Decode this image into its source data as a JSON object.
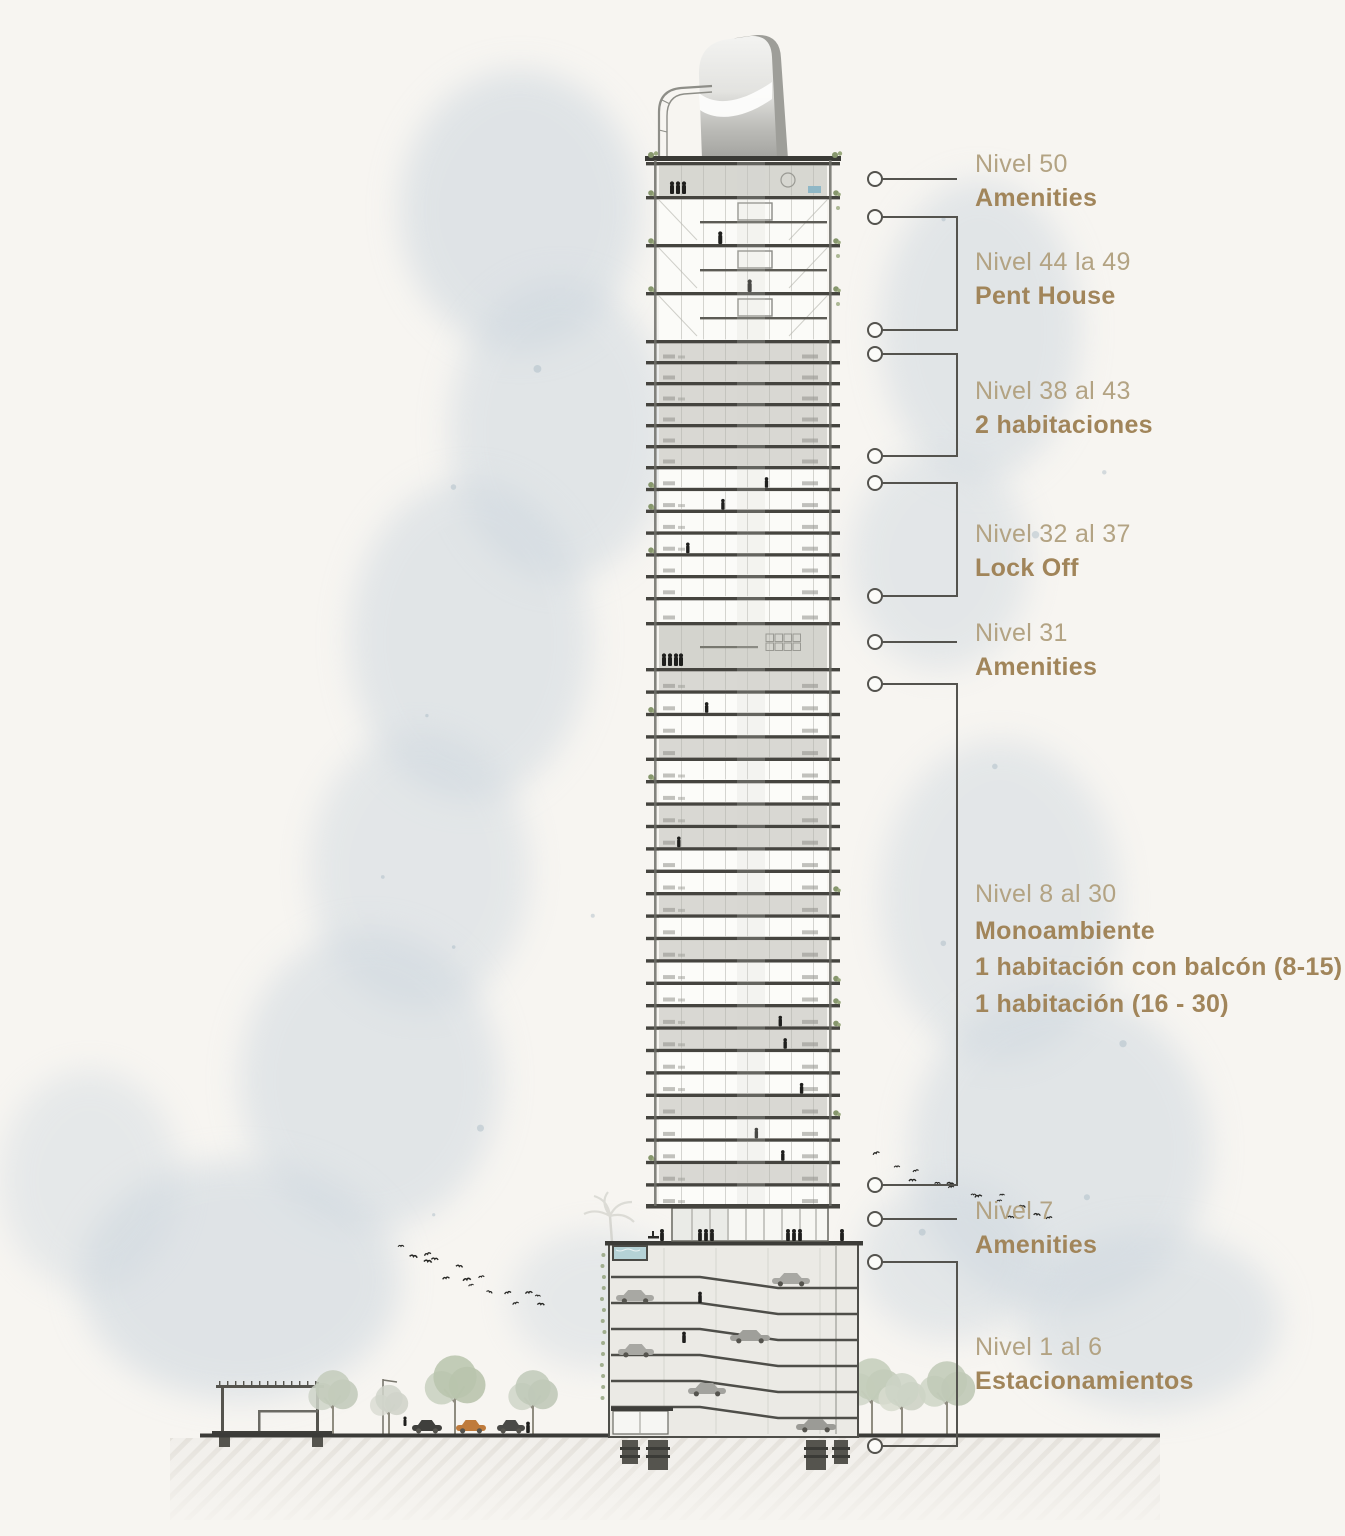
{
  "palette": {
    "background": "#f7f5f1",
    "level_text": "#b3a383",
    "name_text": "#a1855a",
    "connector": "#54534e",
    "slab": "#45443f",
    "gray_floor": "#d9d8d3",
    "white_floor": "#fcfcf9",
    "pool_water": "#b5d2d6",
    "watercolor": "#ccd6de",
    "greenery": "#87976d"
  },
  "annotations": [
    {
      "id": "nivel-50",
      "level": "Nivel 50",
      "name": "Amenities"
    },
    {
      "id": "nivel-44-49",
      "level": "Nivel 44 la 49",
      "name": "Pent House"
    },
    {
      "id": "nivel-38-43",
      "level": "Nivel 38 al 43",
      "name": "2 habitaciones"
    },
    {
      "id": "nivel-32-37",
      "level": "Nivel 32 al 37",
      "name": "Lock Off"
    },
    {
      "id": "nivel-31",
      "level": "Nivel 31",
      "name": "Amenities"
    },
    {
      "id": "nivel-8-30",
      "level": "Nivel 8 al 30",
      "name": "Monoambiente",
      "units": [
        "1 habitación con balcón (8-15)",
        "1 habitación (16 - 30)"
      ]
    },
    {
      "id": "nivel-7",
      "level": "Nivel 7",
      "name": "Amenities"
    },
    {
      "id": "nivel-1-6",
      "level": "Nivel 1 al 6",
      "name": "Estacionamientos"
    }
  ]
}
